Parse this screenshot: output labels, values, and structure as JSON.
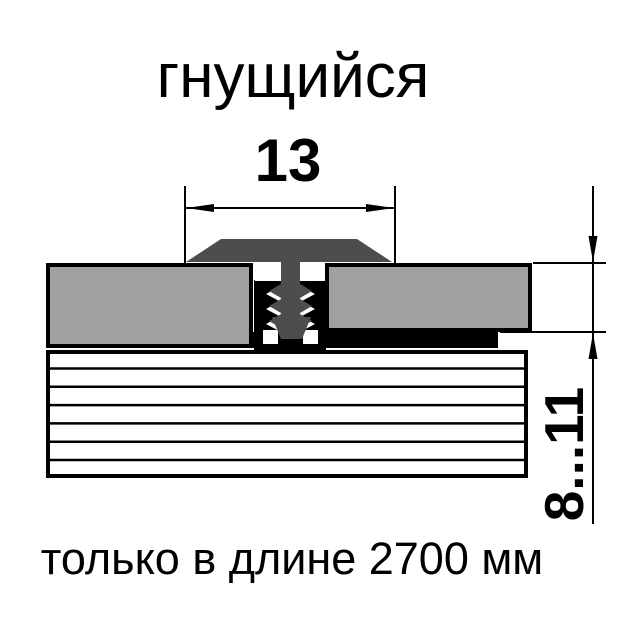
{
  "title": "гнущийся",
  "dimensions": {
    "width_mm": "13",
    "thickness_range_mm": "8...11"
  },
  "note": "только в длине 2700 мм",
  "colors": {
    "panel": "#a0a0a0",
    "profile": "#4d4d4d",
    "line": "#000000",
    "background": "#ffffff"
  }
}
